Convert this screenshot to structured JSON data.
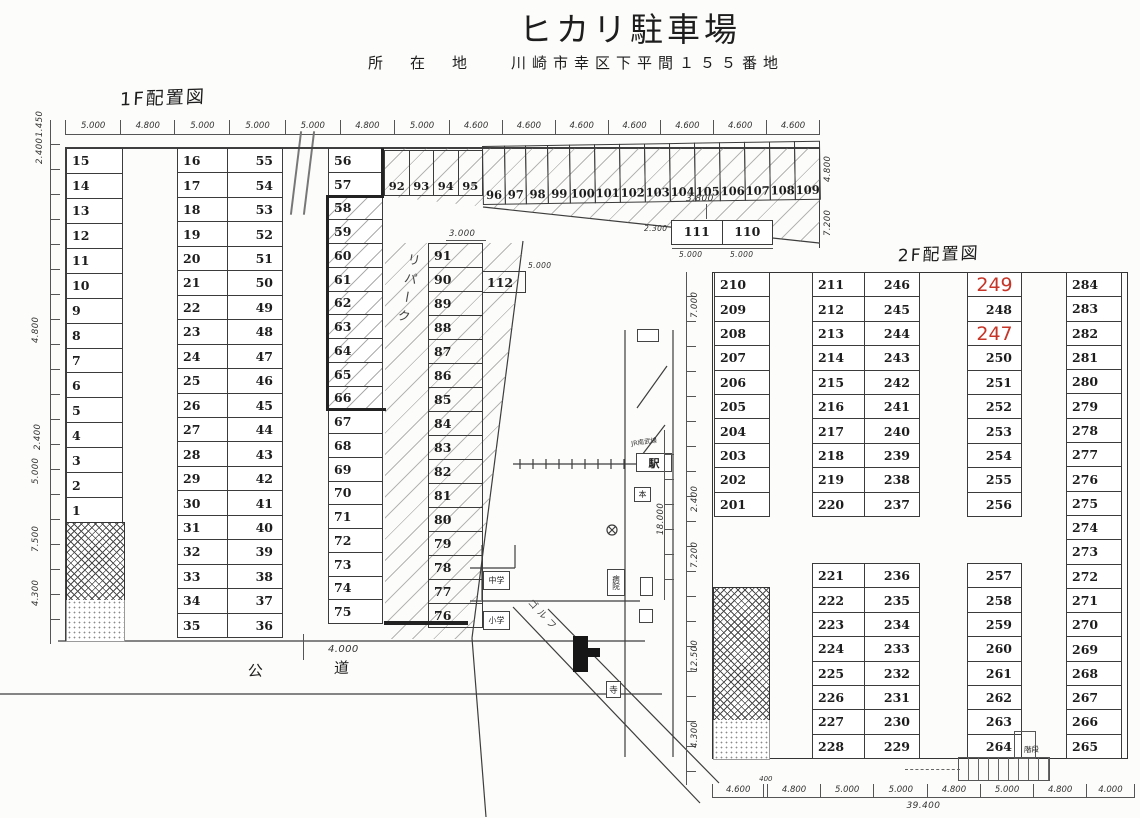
{
  "header": {
    "title": "ヒカリ駐車場",
    "address_label": "所　在　地",
    "address": "川崎市幸区下平間１５５番地"
  },
  "floor1": {
    "label": "1F配置図",
    "lease_label": "リパーク",
    "dims_top": [
      "5.000",
      "4.800",
      "5.000",
      "5.000",
      "5.000",
      "4.800",
      "5.000",
      "4.600",
      "4.600",
      "4.600",
      "4.600",
      "4.600",
      "4.600",
      "4.600"
    ],
    "dims_left": [
      "1.450",
      "2.400",
      "4.800",
      "2.400",
      "5.000",
      "7.500",
      "4.300"
    ],
    "dims_right": [
      "4.800",
      "7.200"
    ],
    "col_a": [
      "15",
      "14",
      "13",
      "12",
      "11",
      "10",
      "9",
      "8",
      "7",
      "6",
      "5",
      "4",
      "3",
      "2",
      "1"
    ],
    "col_b_left": [
      "16",
      "17",
      "18",
      "19",
      "20",
      "21",
      "22",
      "23",
      "24",
      "25",
      "26",
      "27",
      "28",
      "29",
      "30",
      "31",
      "32",
      "33",
      "34",
      "35"
    ],
    "col_b_right": [
      "55",
      "54",
      "53",
      "52",
      "51",
      "50",
      "49",
      "48",
      "47",
      "46",
      "45",
      "44",
      "43",
      "42",
      "41",
      "40",
      "39",
      "38",
      "37",
      "36"
    ],
    "col_c": [
      {
        "label": "56"
      },
      {
        "label": "57"
      },
      {
        "label": "58",
        "hatched": true
      },
      {
        "label": "59",
        "hatched": true
      },
      {
        "label": "60",
        "hatched": true
      },
      {
        "label": "61",
        "hatched": true
      },
      {
        "label": "62",
        "hatched": true
      },
      {
        "label": "63",
        "hatched": true
      },
      {
        "label": "64",
        "hatched": true
      },
      {
        "label": "65",
        "hatched": true
      },
      {
        "label": "66",
        "hatched": true
      },
      {
        "label": "67"
      },
      {
        "label": "68"
      },
      {
        "label": "69"
      },
      {
        "label": "70"
      },
      {
        "label": "71"
      },
      {
        "label": "72"
      },
      {
        "label": "73"
      },
      {
        "label": "74"
      },
      {
        "label": "75"
      }
    ],
    "col_d": [
      "91",
      "90",
      "89",
      "88",
      "87",
      "86",
      "85",
      "84",
      "83",
      "82",
      "81",
      "80",
      "79",
      "78",
      "77",
      "76"
    ],
    "row_92_95": [
      "92",
      "93",
      "94",
      "95"
    ],
    "row_96_109": [
      "96",
      "97",
      "98",
      "99",
      "100",
      "101",
      "102",
      "103",
      "104",
      "105",
      "106",
      "107",
      "108",
      "109"
    ],
    "boxes_111_110": [
      "111",
      "110"
    ],
    "box_112": "112",
    "dims_111": {
      "w": "3.800",
      "h": "2.300",
      "a": "5.000",
      "b": "5.000"
    },
    "dims_112": {
      "w": "3.000",
      "h": "5.000"
    },
    "road": {
      "width": "4.000",
      "label": "公　道"
    }
  },
  "map": {
    "station": "駅",
    "station_note": "JR南武線",
    "school_jr": "中学",
    "school_el": "小学",
    "golf": "ゴルフ",
    "hospital": "病院",
    "temple": "寺",
    "hon": "本"
  },
  "floor2": {
    "label": "2F配置図",
    "col_a": [
      "210",
      "209",
      "208",
      "207",
      "206",
      "205",
      "204",
      "203",
      "202",
      "201"
    ],
    "col_b_left": [
      "211",
      "212",
      "213",
      "214",
      "215",
      "216",
      "217",
      "218",
      "219",
      "220"
    ],
    "col_b_right": [
      "246",
      "245",
      "244",
      "243",
      "242",
      "241",
      "240",
      "239",
      "238",
      "237"
    ],
    "col_c_top": [
      {
        "label": "249",
        "red": true
      },
      {
        "label": "248"
      },
      {
        "label": "247",
        "red": true
      },
      {
        "label": "250"
      },
      {
        "label": "251"
      },
      {
        "label": "252"
      },
      {
        "label": "253"
      },
      {
        "label": "254"
      },
      {
        "label": "255"
      },
      {
        "label": "256"
      }
    ],
    "col_d": [
      "284",
      "283",
      "282",
      "281",
      "280",
      "279",
      "278",
      "277",
      "276",
      "275",
      "274",
      "273",
      "272",
      "271",
      "270",
      "269",
      "268",
      "267",
      "266",
      "265"
    ],
    "col_b2_left": [
      "221",
      "222",
      "223",
      "224",
      "225",
      "226",
      "227",
      "228"
    ],
    "col_b2_right": [
      "236",
      "235",
      "234",
      "233",
      "232",
      "231",
      "230",
      "229"
    ],
    "col_c_bottom": [
      "257",
      "258",
      "259",
      "260",
      "261",
      "262",
      "263",
      "264"
    ],
    "stairs": "階段",
    "dims_left": [
      "7.000",
      "18.000",
      "2.400",
      "7.200",
      "12.500",
      "4.300"
    ],
    "dims_bottom": [
      {
        "label": "4.600",
        "grow": 4.6
      },
      {
        "label": "400",
        "grow": 0.5,
        "above": true
      },
      {
        "label": "4.800",
        "grow": 4.8
      },
      {
        "label": "5.000",
        "grow": 5
      },
      {
        "label": "5.000",
        "grow": 5
      },
      {
        "label": "4.800",
        "grow": 4.8
      },
      {
        "label": "5.000",
        "grow": 5
      },
      {
        "label": "4.800",
        "grow": 4.8
      },
      {
        "label": "4.000",
        "grow": 4
      }
    ],
    "total": "39.400"
  }
}
